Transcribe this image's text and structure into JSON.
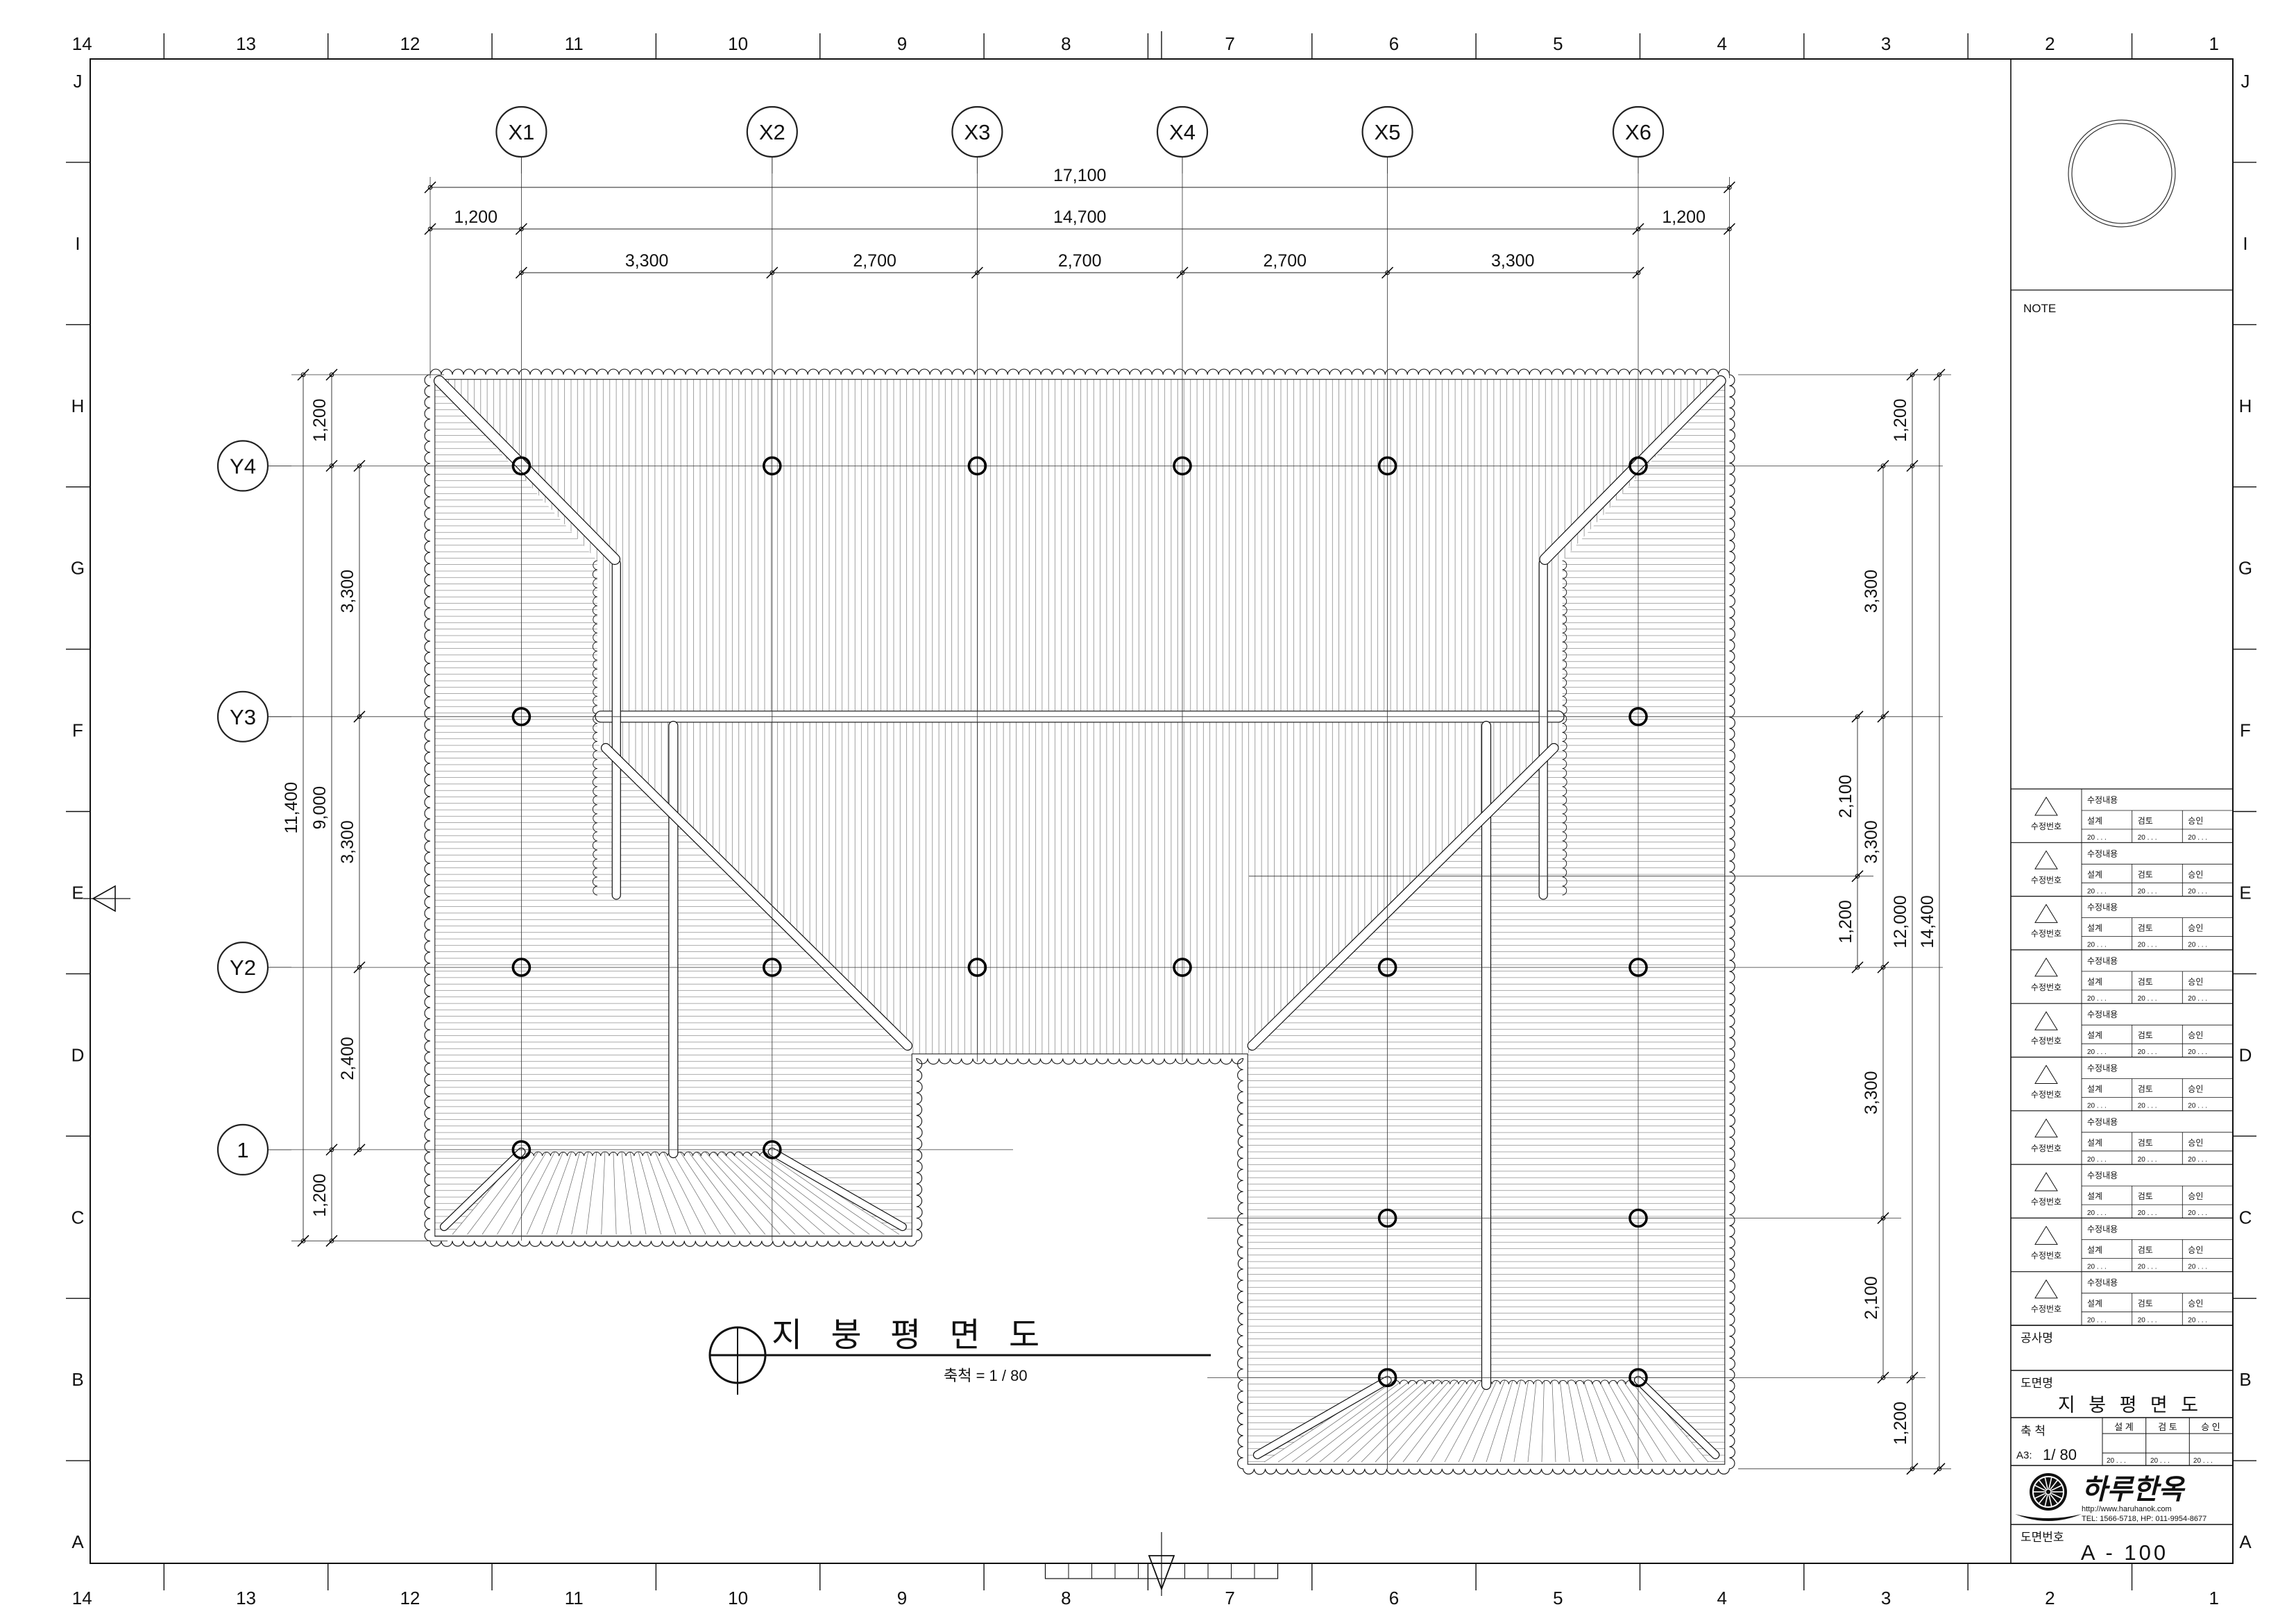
{
  "sheet": {
    "top_numbers": [
      "14",
      "13",
      "12",
      "11",
      "10",
      "9",
      "8",
      "7",
      "6",
      "5",
      "4",
      "3",
      "2",
      "1"
    ],
    "bottom_numbers": [
      "14",
      "13",
      "12",
      "11",
      "10",
      "9",
      "8",
      "7",
      "6",
      "5",
      "4",
      "3",
      "2",
      "1"
    ],
    "left_letters": [
      "J",
      "I",
      "H",
      "G",
      "F",
      "E",
      "D",
      "C",
      "B",
      "A"
    ],
    "right_letters": [
      "J",
      "I",
      "H",
      "G",
      "F",
      "E",
      "D",
      "C",
      "B",
      "A"
    ]
  },
  "grid": {
    "x_labels": [
      "X1",
      "X2",
      "X3",
      "X4",
      "X5",
      "X6"
    ],
    "y_labels": [
      "Y4",
      "Y3",
      "Y2",
      "1"
    ]
  },
  "dims": {
    "top": [
      {
        "labels": [
          "17,100"
        ]
      },
      {
        "labels": [
          "1,200",
          "14,700",
          "1,200"
        ]
      },
      {
        "labels": [
          "3,300",
          "2,700",
          "2,700",
          "2,700",
          "3,300"
        ]
      }
    ],
    "left": [
      {
        "labels": [
          "11,400"
        ]
      },
      {
        "labels": [
          "1,200",
          "9,000",
          "1,200"
        ]
      },
      {
        "labels": [
          "3,300",
          "3,300",
          "2,400"
        ]
      }
    ],
    "right": [
      {
        "labels": [
          "2,100",
          "1,200"
        ]
      },
      {
        "labels": [
          "3,300",
          "3,300",
          "3,300",
          "2,100"
        ]
      },
      {
        "labels": [
          "1,200",
          "12,000",
          "1,200"
        ]
      },
      {
        "labels": [
          "14,400"
        ]
      }
    ]
  },
  "plan_title": {
    "text": "지 붕 평 면 도",
    "scale": "축척 = 1 / 80"
  },
  "title_block": {
    "note_label": "NOTE",
    "revision_row_count": 10,
    "revision": {
      "number_label": "수정번호",
      "content_label": "수정내용",
      "design_label": "설계",
      "review_label": "검토",
      "approve_label": "승인",
      "date_text": "20 .    .    ."
    },
    "project_label": "공사명",
    "drawing_name_label": "도면명",
    "drawing_name": "지 붕 평 면 도",
    "scale_label": "축  척",
    "scale_sheet": "A3:",
    "scale_value": "1/ 80",
    "sign": {
      "design_label": "설  계",
      "review_label": "검  토",
      "approve_label": "승  인",
      "date_text": "20 .    .    ."
    },
    "logo": {
      "name": "하루한옥",
      "url": "http://www.haruhanok.com",
      "tel": "TEL: 1566-5718, HP: 011-9954-8677"
    },
    "number_label": "도면번호",
    "drawing_number": "A  -  100"
  }
}
